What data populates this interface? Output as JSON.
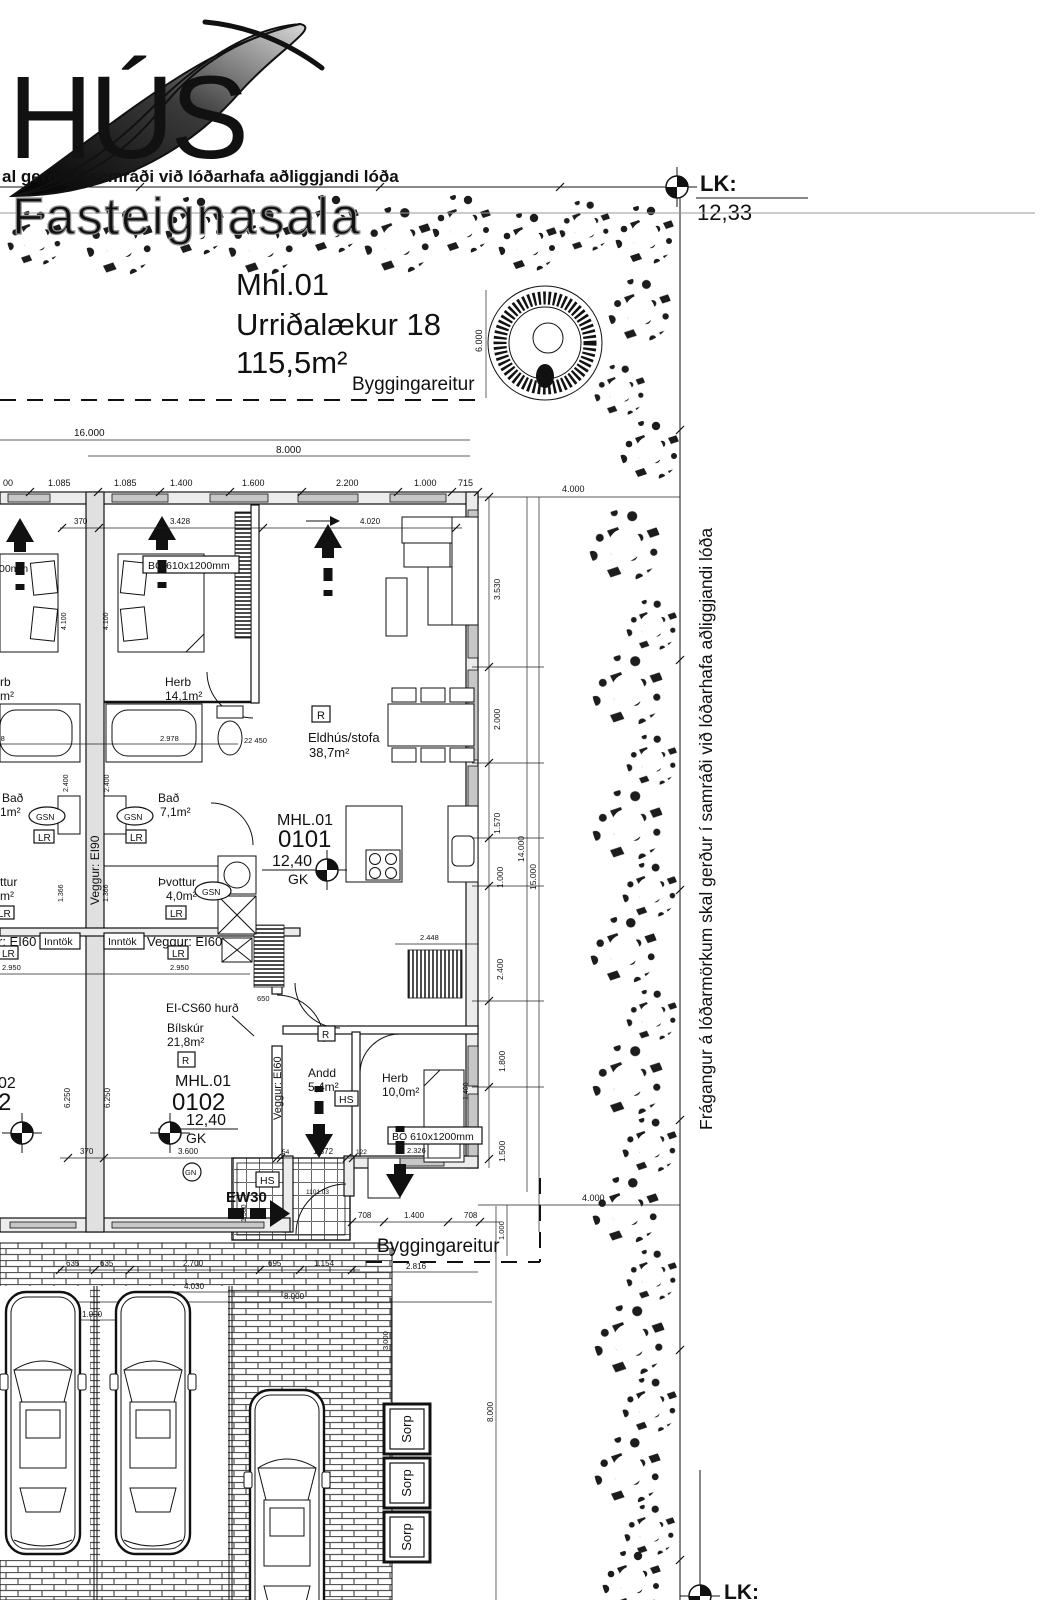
{
  "logo": {
    "name": "HÚS",
    "subtitle": "Fasteignasala"
  },
  "notes": {
    "top": "al gerður í samráði við lóðarhafa aðliggjandi lóða",
    "boundary": "Frágangur á lóðarmörkum skal gerður í samráði við lóðarhafa aðliggjandi lóða"
  },
  "survey": {
    "top_label": "LK:",
    "top_value": "12,33",
    "bottom_label": "LK:"
  },
  "site": {
    "building": "Mhl.01",
    "address": "Urriðalækur 18",
    "area": "115,5m²",
    "plot_top": "Byggingareitur",
    "plot_bottom": "Byggingareitur"
  },
  "units": {
    "a": {
      "id": "MHL.01",
      "nr": "0101",
      "lvl": "12,40",
      "datum": "GK"
    },
    "b": {
      "id": "MHL.01",
      "nr": "0102",
      "lvl": "12,40",
      "datum": "GK"
    },
    "neighbor_nr": "02",
    "neighbor_big": "2"
  },
  "rooms": {
    "herb1": {
      "n": "Herb",
      "a": "14,1m²"
    },
    "eldhus": {
      "n": "Eldhús/stofa",
      "a": "38,7m²"
    },
    "bad": {
      "n": "Bað",
      "a": "7,1m²"
    },
    "thvottur": {
      "n": "Þvottur",
      "a": "4,0m²"
    },
    "bilskur": {
      "n": "Bílskúr",
      "a": "21,8m²"
    },
    "andd": {
      "n": "Andd",
      "a": "5,4m²"
    },
    "herb2": {
      "n": "Herb",
      "a": "10,0m²"
    }
  },
  "neighbor": {
    "bad": "Bað",
    "bad_a": "1m²",
    "thv": "ttur",
    "thv_a": "m²",
    "herb": "rb",
    "herb_a": "m²",
    "win": "00mm",
    "wall": "r: EI60"
  },
  "tags": {
    "window": "BO 610x1200mm",
    "inntok": "Inntök",
    "lr": "LR",
    "gsn": "GSN",
    "hs": "HS",
    "smoke": "R",
    "gn": "GN",
    "ew": "EW30",
    "door": "EI-CS60 hurð",
    "wall90": "Veggur: EI90",
    "wall60": "Veggur: EI60",
    "sorp": "Sorp"
  },
  "dims": {
    "d16000": "16.000",
    "d8000": "8.000",
    "d00": "00",
    "d1085": "1.085",
    "d1400": "1.400",
    "d1600": "1.600",
    "d2200": "2.200",
    "d1000": "1.000",
    "d715": "715",
    "d4000": "4.000",
    "d6000": "6.000",
    "d3530": "3.530",
    "d2000": "2.000",
    "d1570": "1.570",
    "d2400": "2.400",
    "d1800": "1.800",
    "d1500": "1.500",
    "d14000": "14.000",
    "d15000": "15.000",
    "d370": "370",
    "d3428": "3.428",
    "d4020": "4.020",
    "d2978": "2.978",
    "d1366": "1.366",
    "d4100": "4.100",
    "d2950": "2.950",
    "d450": "22 450",
    "d650": "650",
    "d6250": "6.250",
    "d3600": "3.600",
    "d54": "54",
    "d1372": "1.372",
    "d122": "122",
    "d2326": "2.326",
    "d2448": "2.448",
    "d708": "708",
    "d2816": "2.816",
    "d1101": "1101.03",
    "d635": "635",
    "d2700": "2.700",
    "d695": "695",
    "d1154": "1.154",
    "d4030": "4.030",
    "d3000": "3.000"
  }
}
